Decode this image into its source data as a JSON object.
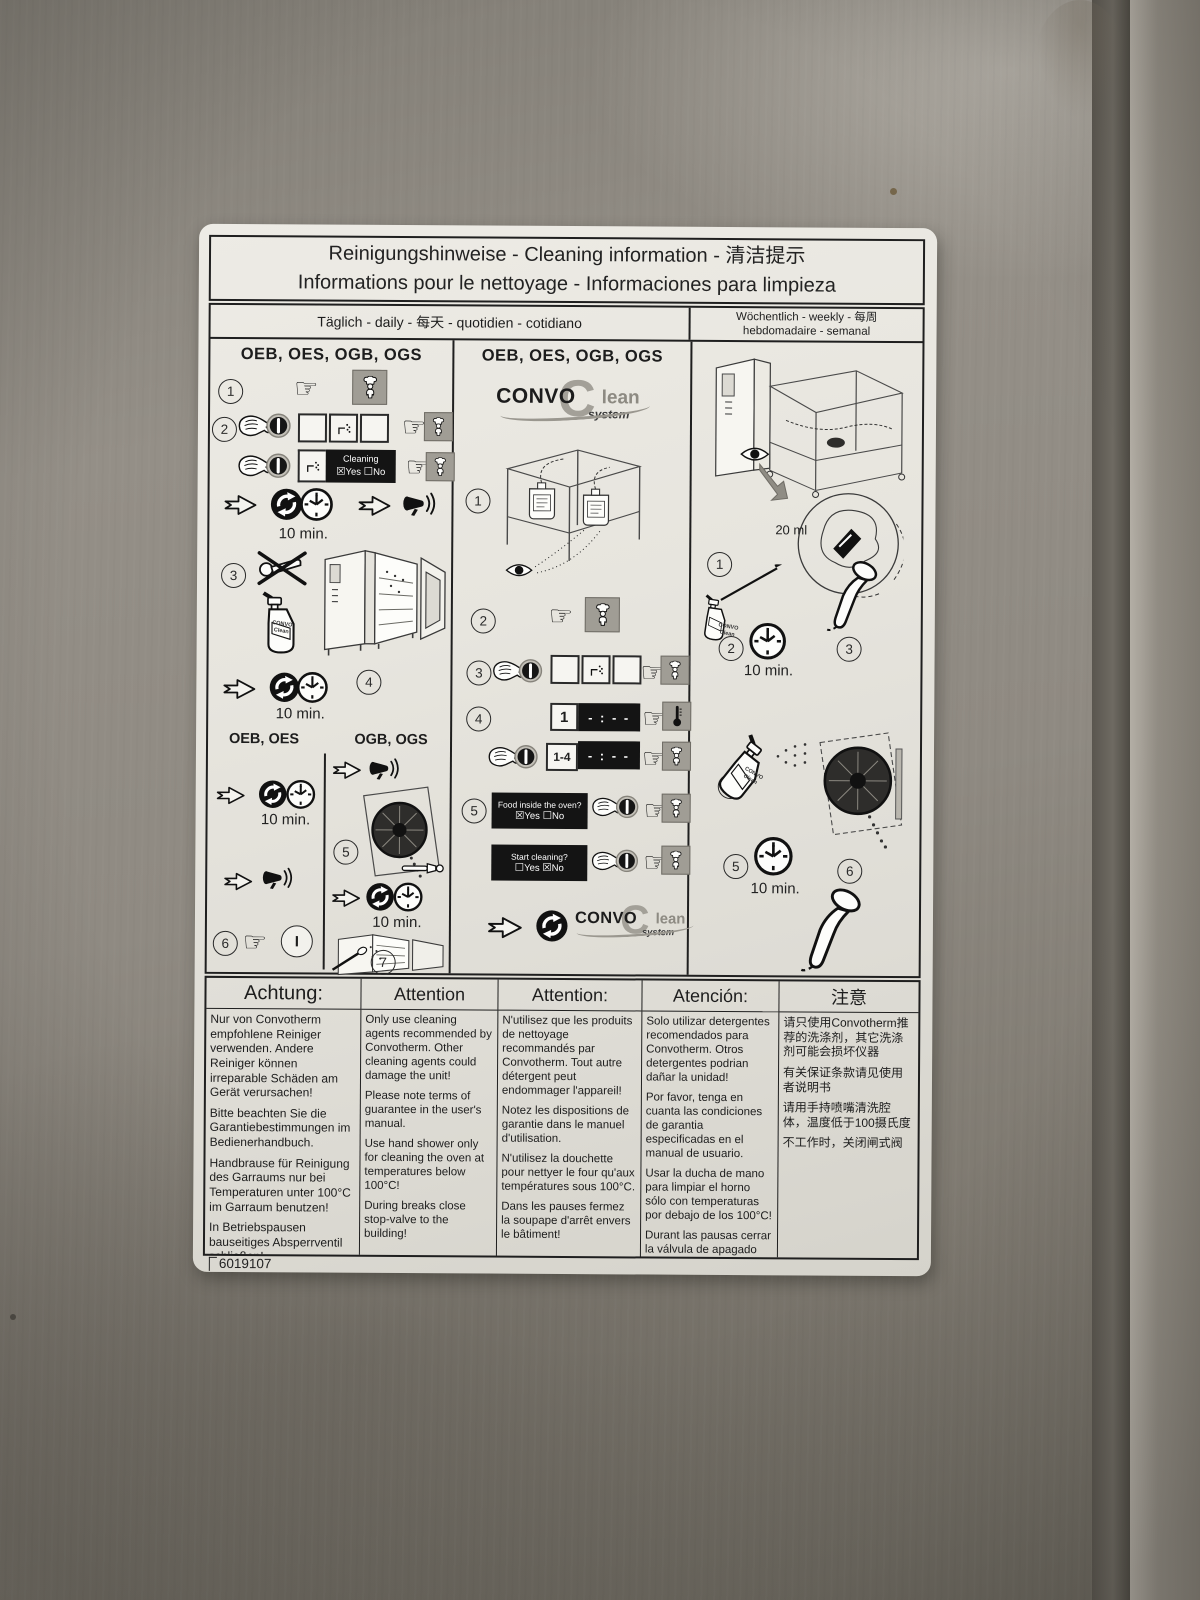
{
  "colors": {
    "steel": "#8f8b83",
    "label_bg": "#e7e5de",
    "display_bg": "#141414",
    "button_grey": "#a09d95",
    "logo_grey": "#9a978f"
  },
  "title": {
    "line1": "Reinigungshinweise - Cleaning information - 清洁提示",
    "line2": "Informations pour le nettoyage - Informaciones para limpieza"
  },
  "schedule": {
    "daily": "Täglich - daily - 每天 - quotidien - cotidiano",
    "weekly_line1": "Wöchentlich - weekly - 每周",
    "weekly_line2": "hebdomadaire - semanal"
  },
  "steps": {
    "n1": "1",
    "n2": "2",
    "n3": "3",
    "n4": "4",
    "n5": "5",
    "n6": "6",
    "n7": "7"
  },
  "labels": {
    "ten_min": "10 min.",
    "twenty_ml": "20 ml",
    "power": "I",
    "cleaning": "Cleaning",
    "yes": "Yes",
    "no": "No",
    "food_q": "Food inside the oven?",
    "start_q": "Start cleaning?",
    "time_display": "- : - -",
    "rack_one": "1",
    "rack_range": "1-4",
    "bottle_line1": "CONVO",
    "bottle_line2": "Clean"
  },
  "icons": {
    "pointing_hand": "☞",
    "checkbox_checked": "☒",
    "checkbox_unchecked": "☐"
  },
  "col1": {
    "heading": "OEB, OES, OGB, OGS",
    "sub_left": "OEB, OES",
    "sub_right": "OGB, OGS"
  },
  "col2": {
    "heading": "OEB, OES, OGB, OGS"
  },
  "logo": {
    "c": "C",
    "convo": "CONVO",
    "lean": "lean",
    "system": "system"
  },
  "attention": {
    "columns": [
      {
        "header": "Achtung:",
        "paragraphs": [
          "Nur von Convotherm empfohlene Reiniger verwenden. Andere Reiniger können irreparable Schäden am Gerät verursachen!",
          "Bitte beachten Sie die Garantiebestimmungen im Bedienerhandbuch.",
          "Handbrause für Reinigung des Garraums nur bei Temperaturen unter 100°C im Garraum benutzen!",
          "In Betriebspausen bauseitiges Absperrventil schließen!"
        ]
      },
      {
        "header": "Attention",
        "paragraphs": [
          "Only use cleaning agents recommended by Convotherm. Other cleaning agents could damage the unit!",
          "Please note terms of guarantee in the user's manual.",
          "Use hand shower only for cleaning the oven at temperatures below 100°C!",
          "During breaks close stop-valve to the building!"
        ]
      },
      {
        "header": "Attention:",
        "paragraphs": [
          "N'utilisez que les produits de nettoyage recommandés par Convotherm. Tout autre détergent peut endommager l'appareil!",
          "Notez les dispositions de garantie dans le manuel d'utilisation.",
          "N'utilisez la douchette pour nettyer le four qu'aux températures sous 100°C.",
          "Dans les pauses fermez la soupape d'arrêt envers le bâtiment!"
        ]
      },
      {
        "header": "Atención:",
        "paragraphs": [
          "Solo utilizar detergentes recomendados para Convotherm. Otros detergentes podrian dañar la unidad!",
          "Por favor, tenga en cuanta las condiciones de garantia especificadas en el manual de usuario.",
          "Usar la ducha de mano para limpiar el horno sólo con temperaturas por debajo de los 100°C!",
          "Durant las pausas cerrar la válvula de apagado hacia el edificio!"
        ]
      },
      {
        "header": "注意",
        "paragraphs": [
          "请只使用Convotherm推荐的洗涤剂，其它洗涤剂可能会损坏仪器",
          "有关保证条款请见使用者说明书",
          "请用手持喷嘴清洗腔体，温度低于100摄氏度",
          "不工作时，关闭闸式阀"
        ]
      }
    ]
  },
  "footer": {
    "code": "6019107"
  }
}
